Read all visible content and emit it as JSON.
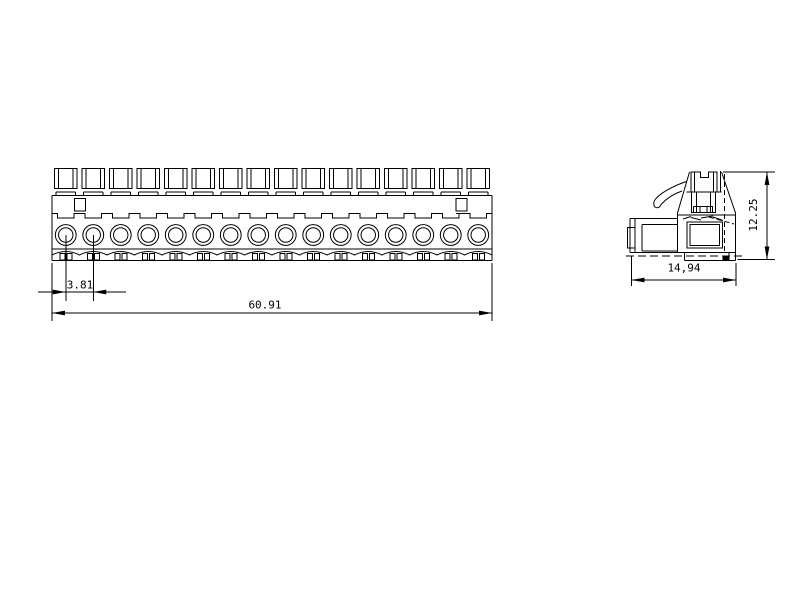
{
  "drawing": {
    "background_color": "#ffffff",
    "line_color": "#000000",
    "front_view": {
      "pin_count": 16
    },
    "dimensions": {
      "pin_pitch": "3.81",
      "overall_width": "60.91",
      "side_depth": "14,94",
      "side_height": "12.25"
    }
  }
}
